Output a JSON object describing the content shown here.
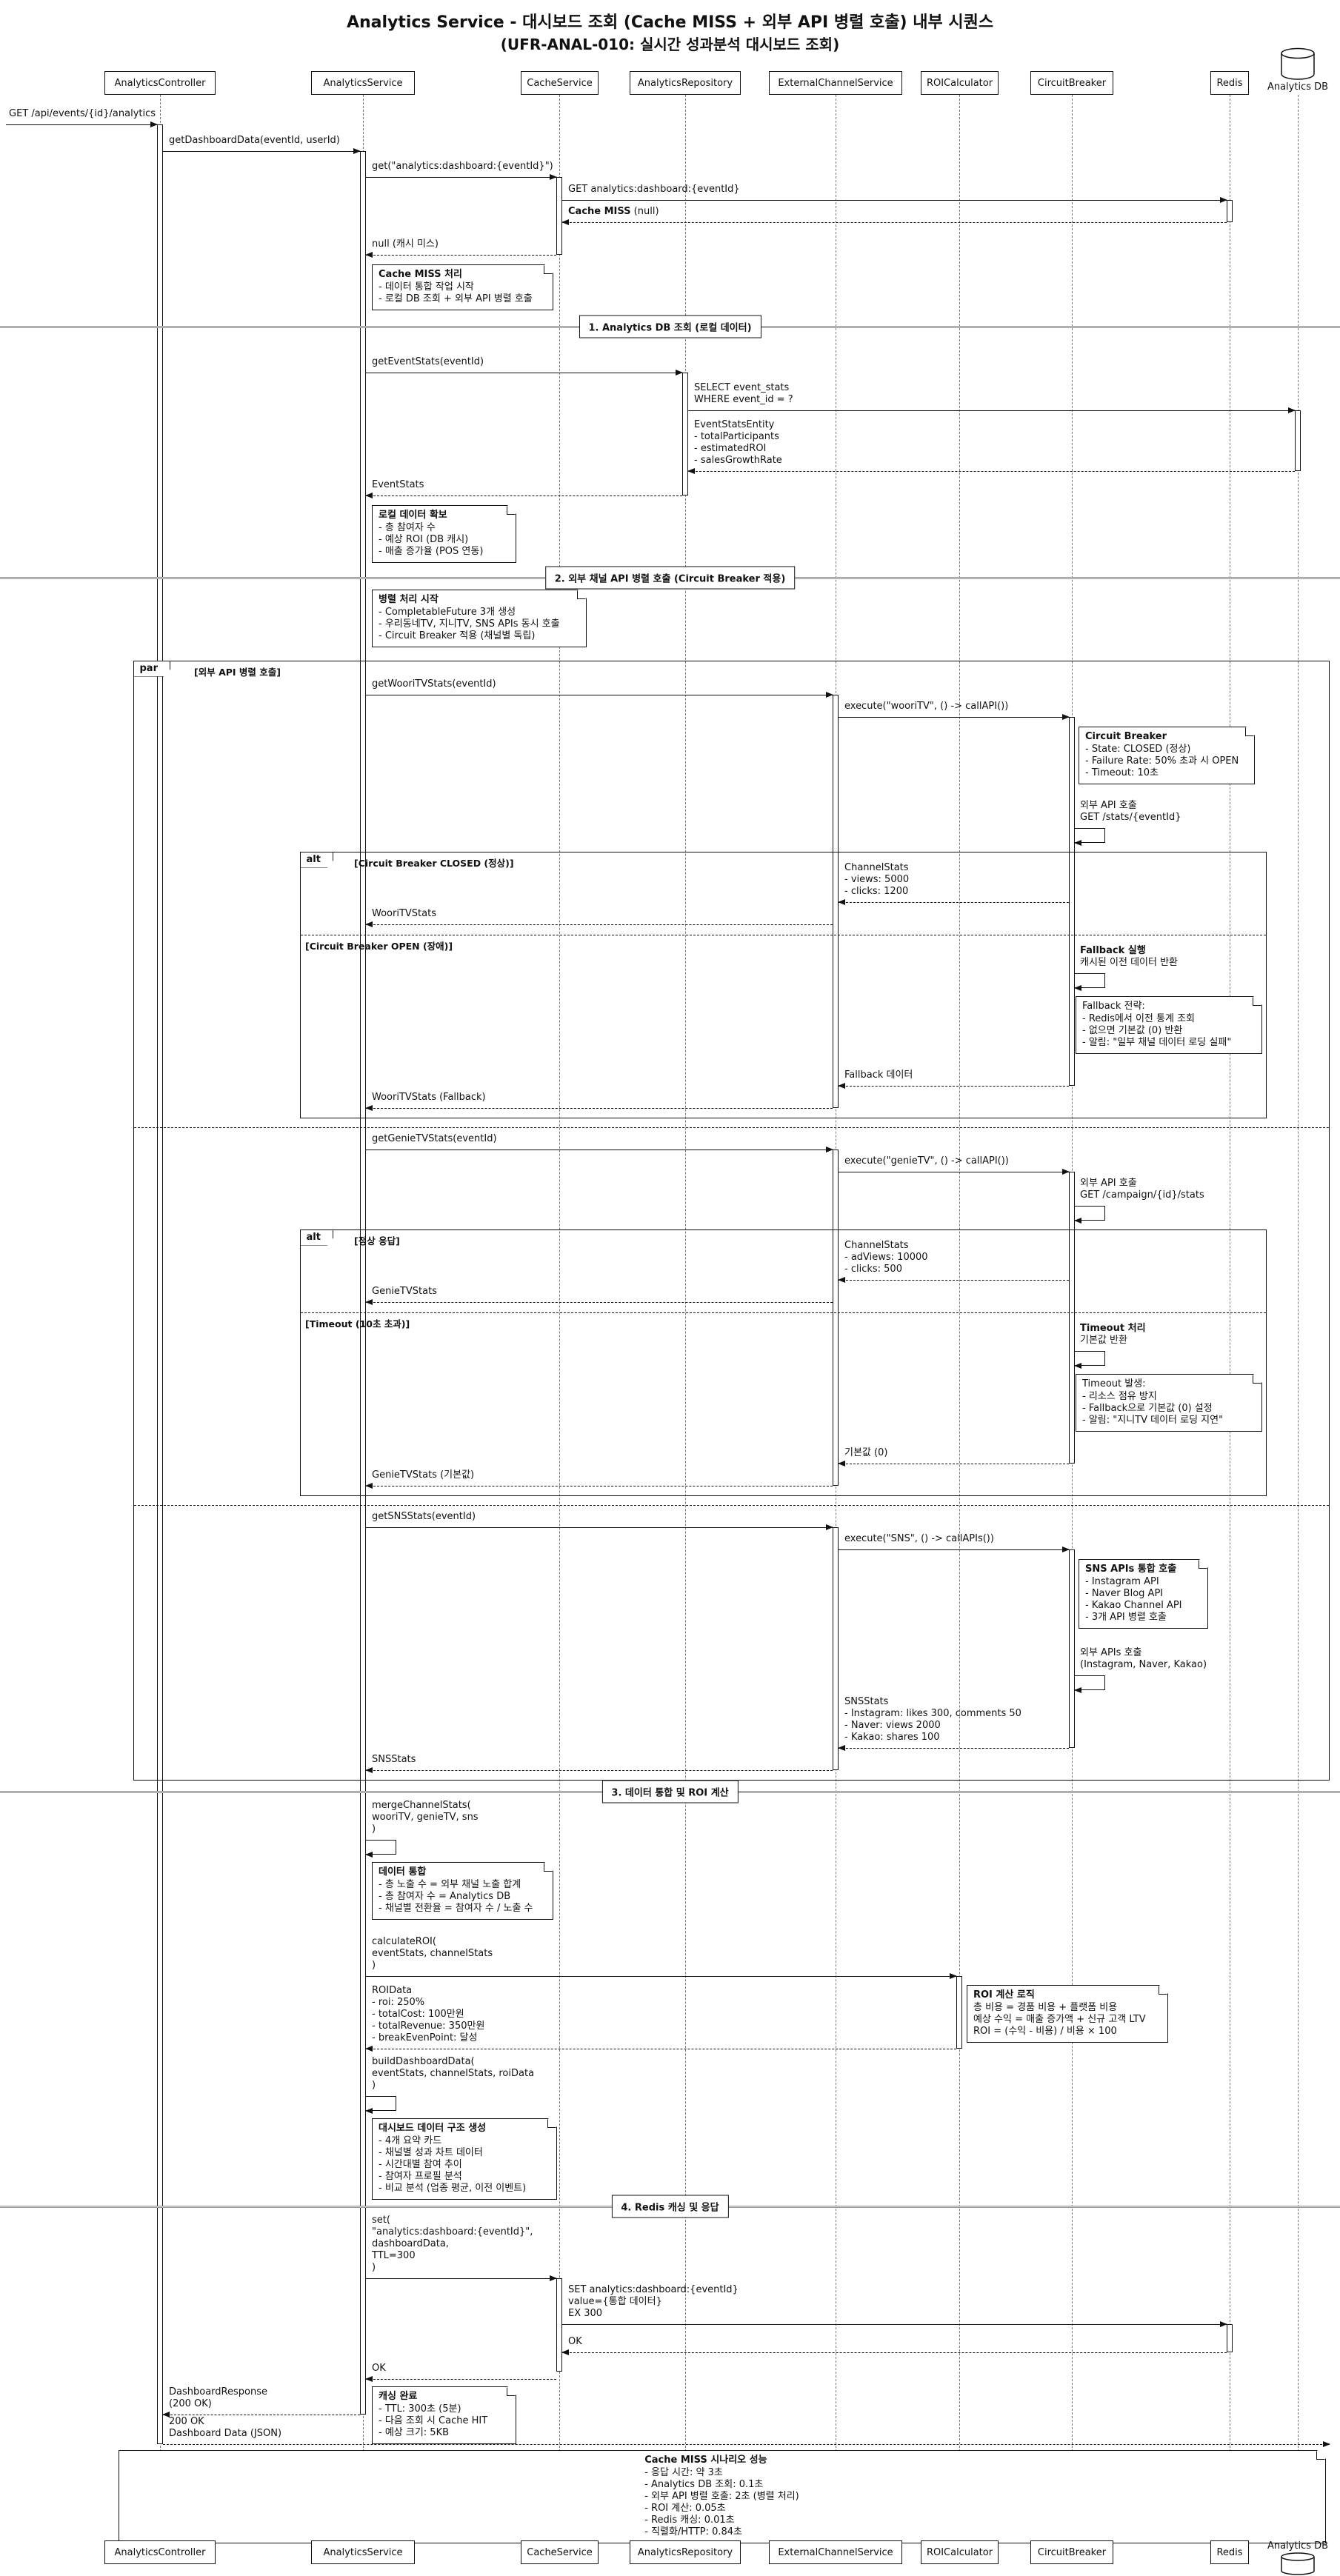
{
  "title": {
    "line1": "Analytics Service - 대시보드 조회 (Cache MISS + 외부 API 병렬 호출) 내부 시퀀스",
    "line2": "(UFR-ANAL-010: 실시간 성과분석 대시보드 조회)"
  },
  "participants": {
    "controller": "AnalyticsController",
    "service": "AnalyticsService",
    "cache": "CacheService",
    "repository": "AnalyticsRepository",
    "external": "ExternalChannelService",
    "roi": "ROICalculator",
    "breaker": "CircuitBreaker",
    "redis": "Redis",
    "db": "Analytics DB"
  },
  "dividers": {
    "d1": "1. Analytics DB 조회 (로컬 데이터)",
    "d2": "2. 외부 채널 API 병렬 호출 (Circuit Breaker 적용)",
    "d3": "3. 데이터 통합 및 ROI 계산",
    "d4": "4. Redis 캐싱 및 응답"
  },
  "fragments": {
    "par_tag": "par",
    "par_cond": "[외부 API 병렬 호출]",
    "alt_tag": "alt",
    "alt1_cond": "[Circuit Breaker CLOSED (정상)]",
    "alt1_else": "[Circuit Breaker OPEN (장애)]",
    "alt2_cond": "[정상 응답]",
    "alt2_else": "[Timeout (10초 초과)]"
  },
  "messages": {
    "m1": "GET /api/events/{id}/analytics",
    "m2": "getDashboardData(eventId, userId)",
    "m3": "get(\"analytics:dashboard:{eventId}\")",
    "m4": "GET analytics:dashboard:{eventId}",
    "m5": {
      "bold": "Cache MISS",
      "rest": " (null)"
    },
    "m6": "null (캐시 미스)",
    "m7": "getEventStats(eventId)",
    "m8": "SELECT event_stats\nWHERE event_id = ?",
    "m9": "EventStatsEntity\n- totalParticipants\n- estimatedROI\n- salesGrowthRate",
    "m10": "EventStats",
    "m11": "getWooriTVStats(eventId)",
    "m12": "execute(\"wooriTV\", () -> callAPI())",
    "m13": "외부 API 호출\nGET /stats/{eventId}",
    "m14": "ChannelStats\n- views: 5000\n- clicks: 1200",
    "m15": "WooriTVStats",
    "m16": {
      "bold": "Fallback 실행",
      "rest": "캐시된 이전 데이터 반환"
    },
    "m17": "Fallback 데이터",
    "m18": "WooriTVStats (Fallback)",
    "m19": "getGenieTVStats(eventId)",
    "m20": "execute(\"genieTV\", () -> callAPI())",
    "m21": "외부 API 호출\nGET /campaign/{id}/stats",
    "m22": "ChannelStats\n- adViews: 10000\n- clicks: 500",
    "m23": "GenieTVStats",
    "m24": {
      "bold": "Timeout 처리",
      "rest": "기본값 반환"
    },
    "m25": "기본값 (0)",
    "m26": "GenieTVStats (기본값)",
    "m27": "getSNSStats(eventId)",
    "m28": "execute(\"SNS\", () -> callAPIs())",
    "m29": "외부 APIs 호출\n(Instagram, Naver, Kakao)",
    "m30": "SNSStats\n- Instagram: likes 300, comments 50\n- Naver: views 2000\n- Kakao: shares 100",
    "m31": "SNSStats",
    "m32": "mergeChannelStats(\n  wooriTV, genieTV, sns\n)",
    "m33": "calculateROI(\n  eventStats, channelStats\n)",
    "m34": "ROIData\n- roi: 250%\n- totalCost: 100만원\n- totalRevenue: 350만원\n- breakEvenPoint: 달성",
    "m35": "buildDashboardData(\n  eventStats, channelStats, roiData\n)",
    "m36": "set(\n  \"analytics:dashboard:{eventId}\",\n  dashboardData,\n  TTL=300\n)",
    "m37": "SET analytics:dashboard:{eventId}\nvalue={통합 데이터}\nEX 300",
    "m38": "OK",
    "m39": "OK",
    "m40": "DashboardResponse\n(200 OK)",
    "m41": "200 OK\nDashboard Data (JSON)"
  },
  "notes": {
    "n1": {
      "title": "Cache MISS 처리",
      "lines": [
        "- 데이터 통합 작업 시작",
        "- 로컬 DB 조회 + 외부 API 병렬 호출"
      ]
    },
    "n2": {
      "title": "로컬 데이터 확보",
      "lines": [
        "- 총 참여자 수",
        "- 예상 ROI (DB 캐시)",
        "- 매출 증가율 (POS 연동)"
      ]
    },
    "n3": {
      "title": "병렬 처리 시작",
      "lines": [
        "- CompletableFuture 3개 생성",
        "- 우리동네TV, 지니TV, SNS APIs 동시 호출",
        "- Circuit Breaker 적용 (채널별 독립)"
      ]
    },
    "n4": {
      "title": "Circuit Breaker",
      "lines": [
        "- State: CLOSED (정상)",
        "- Failure Rate: 50% 초과 시 OPEN",
        "- Timeout: 10초"
      ]
    },
    "n5": {
      "title": "Fallback 전략:",
      "lines": [
        "- Redis에서 이전 통계 조회",
        "- 없으면 기본값 (0) 반환",
        "- 알림: \"일부 채널 데이터 로딩 실패\""
      ]
    },
    "n6": {
      "title": "Timeout 발생:",
      "lines": [
        "- 리소스 점유 방지",
        "- Fallback으로 기본값 (0) 설정",
        "- 알림: \"지니TV 데이터 로딩 지연\""
      ]
    },
    "n7": {
      "title": "SNS APIs 통합 호출",
      "lines": [
        "- Instagram API",
        "- Naver Blog API",
        "- Kakao Channel API",
        "- 3개 API 병렬 호출"
      ]
    },
    "n8": {
      "title": "데이터 통합",
      "lines": [
        "- 총 노출 수 = 외부 채널 노출 합계",
        "- 총 참여자 수 = Analytics DB",
        "- 채널별 전환율 = 참여자 수 / 노출 수"
      ]
    },
    "n9": {
      "title": "ROI 계산 로직",
      "lines": [
        "총 비용 = 경품 비용 + 플랫폼 비용",
        "예상 수익 = 매출 증가액 + 신규 고객 LTV",
        "ROI = (수익 - 비용) / 비용 × 100"
      ]
    },
    "n10": {
      "title": "대시보드 데이터 구조 생성",
      "lines": [
        "- 4개 요약 카드",
        "- 채널별 성과 차트 데이터",
        "- 시간대별 참여 추이",
        "- 참여자 프로필 분석",
        "- 비교 분석 (업종 평균, 이전 이벤트)"
      ]
    },
    "n11": {
      "title": "캐싱 완료",
      "lines": [
        "- TTL: 300초 (5분)",
        "- 다음 조회 시 Cache HIT",
        "- 예상 크기: 5KB"
      ]
    },
    "n12": {
      "title": "Cache MISS 시나리오 성능",
      "lines": [
        "- 응답 시간: 약 3초",
        "- Analytics DB 조회: 0.1초",
        "- 외부 API 병렬 호출: 2초 (병렬 처리)",
        "- ROI 계산: 0.05초",
        "- Redis 캐싱: 0.01초",
        "- 직렬화/HTTP: 0.84초"
      ]
    }
  }
}
